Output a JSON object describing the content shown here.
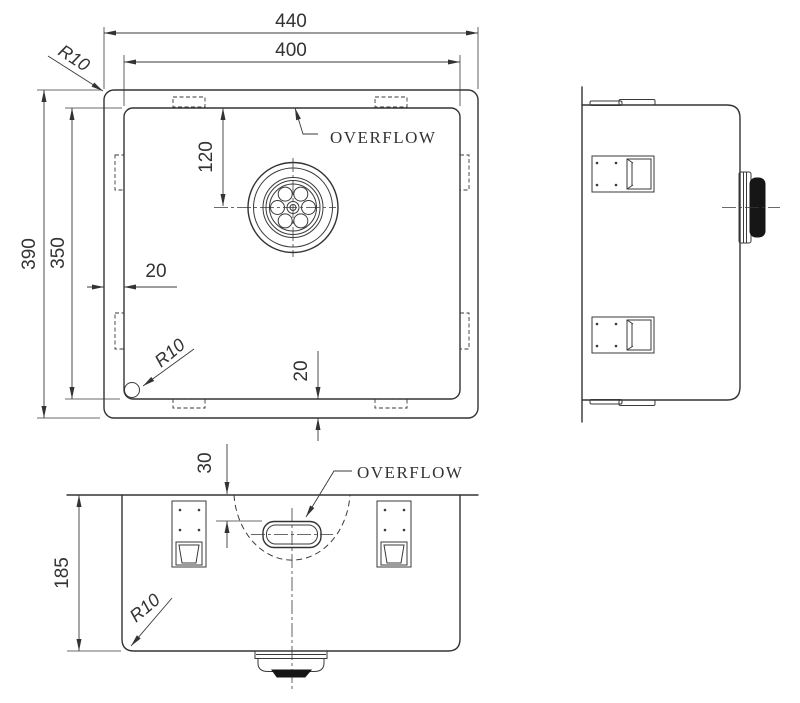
{
  "top_view": {
    "dim_outer_width": "440",
    "dim_inner_width": "400",
    "dim_outer_height": "390",
    "dim_inner_height": "350",
    "dim_drain_offset": "120",
    "dim_left_wall_gap": "20",
    "dim_bottom_wall_gap": "20",
    "radius_outer_corner": "R10",
    "radius_inner_corner": "R10",
    "overflow_label": "OVERFLOW"
  },
  "front_view": {
    "dim_overflow_offset": "30",
    "dim_depth": "185",
    "radius_corner": "R10",
    "overflow_label": "OVERFLOW"
  },
  "colors": {
    "line": "#333333",
    "dim": "#3a3a3a",
    "drain_fill": "#161616",
    "background": "#ffffff"
  }
}
